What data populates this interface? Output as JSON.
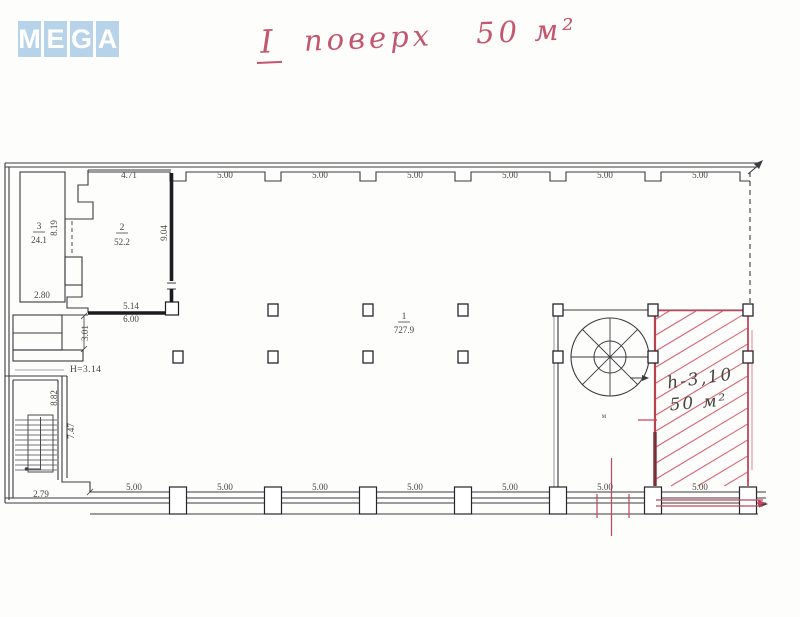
{
  "logo": {
    "letters": [
      "M",
      "E",
      "G",
      "A"
    ]
  },
  "title": {
    "roman": "I",
    "word": "поверх",
    "area": "50 м²"
  },
  "plan": {
    "dims_top": [
      "4.71",
      "5.00",
      "5.00",
      "5.00",
      "5.00",
      "5.00",
      "5.00"
    ],
    "dims_bottom": [
      "5.00",
      "5.00",
      "5.00",
      "5.00",
      "5.00",
      "5.00",
      "5.00"
    ],
    "room3": {
      "number": "3",
      "area": "24.1",
      "side": "8.19",
      "width": "2.80"
    },
    "room2": {
      "number": "2",
      "area": "52.2",
      "side": "9.04",
      "bottom_a": "5.14",
      "bottom_b": "6.00"
    },
    "hall": {
      "number": "1",
      "area": "727.9"
    },
    "entry": {
      "depth": "3.01",
      "height_note": "H=3.14"
    },
    "stairwell": {
      "len_a": "8.82",
      "len_b": "7.47",
      "width": "2.79",
      "mark": "м"
    },
    "red_zone": {
      "height": "h-3,10",
      "area": "50 м²"
    }
  },
  "colors": {
    "logo_tile": "#b7d3e9",
    "title_red": "#c4566e",
    "mark_red": "#c2455a",
    "hatch_red": "#d04a5e",
    "edge_dark_red": "#7c2e36",
    "note_blue": "#2b4fa0",
    "line_dark": "#3a3a40"
  }
}
